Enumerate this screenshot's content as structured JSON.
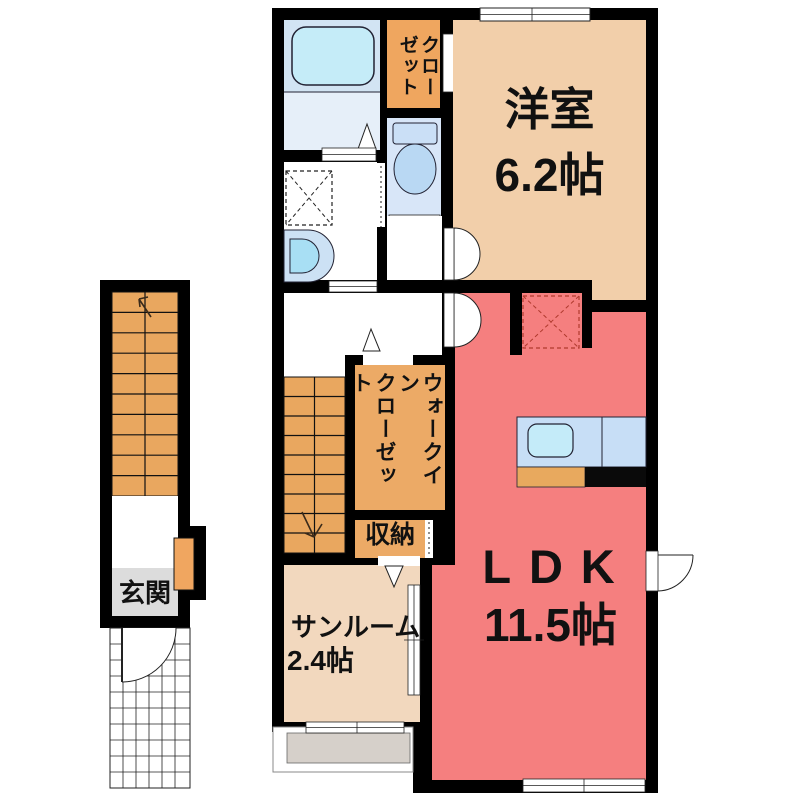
{
  "plan_title": "apartment-floor-plan",
  "rooms": {
    "western_room": {
      "label": "洋室",
      "size": "6.2帖"
    },
    "ldk": {
      "label": "LDK",
      "size": "11.5帖"
    },
    "sunroom": {
      "label": "サンルーム",
      "size": "2.4帖"
    },
    "closet": {
      "label": "クロー\nゼット"
    },
    "walk_in_closet": {
      "label": "ウォークイン\nクローゼット"
    },
    "storage": {
      "label": "収納"
    },
    "entrance": {
      "label": "玄関"
    }
  },
  "colors": {
    "wall": "#000000",
    "western_room_fill": "#F2CFAA",
    "ldk_fill": "#F57F7F",
    "sunroom_fill": "#F2D8BE",
    "closet_fill": "#EFA65F",
    "wic_fill": "#ECAA66",
    "stairs_fill": "#E9A75F",
    "entrance_fill": "#DCDCDC",
    "bath_floor": "#D2E4F3",
    "washroom_floor": "#E6EFF9",
    "bathtub": "#C5ECF8",
    "toilet_floor": "#D8E6F8",
    "counter": "#C7DEF6",
    "sink": "#C4EBF9",
    "appliance_dash": "#B03A2E"
  }
}
